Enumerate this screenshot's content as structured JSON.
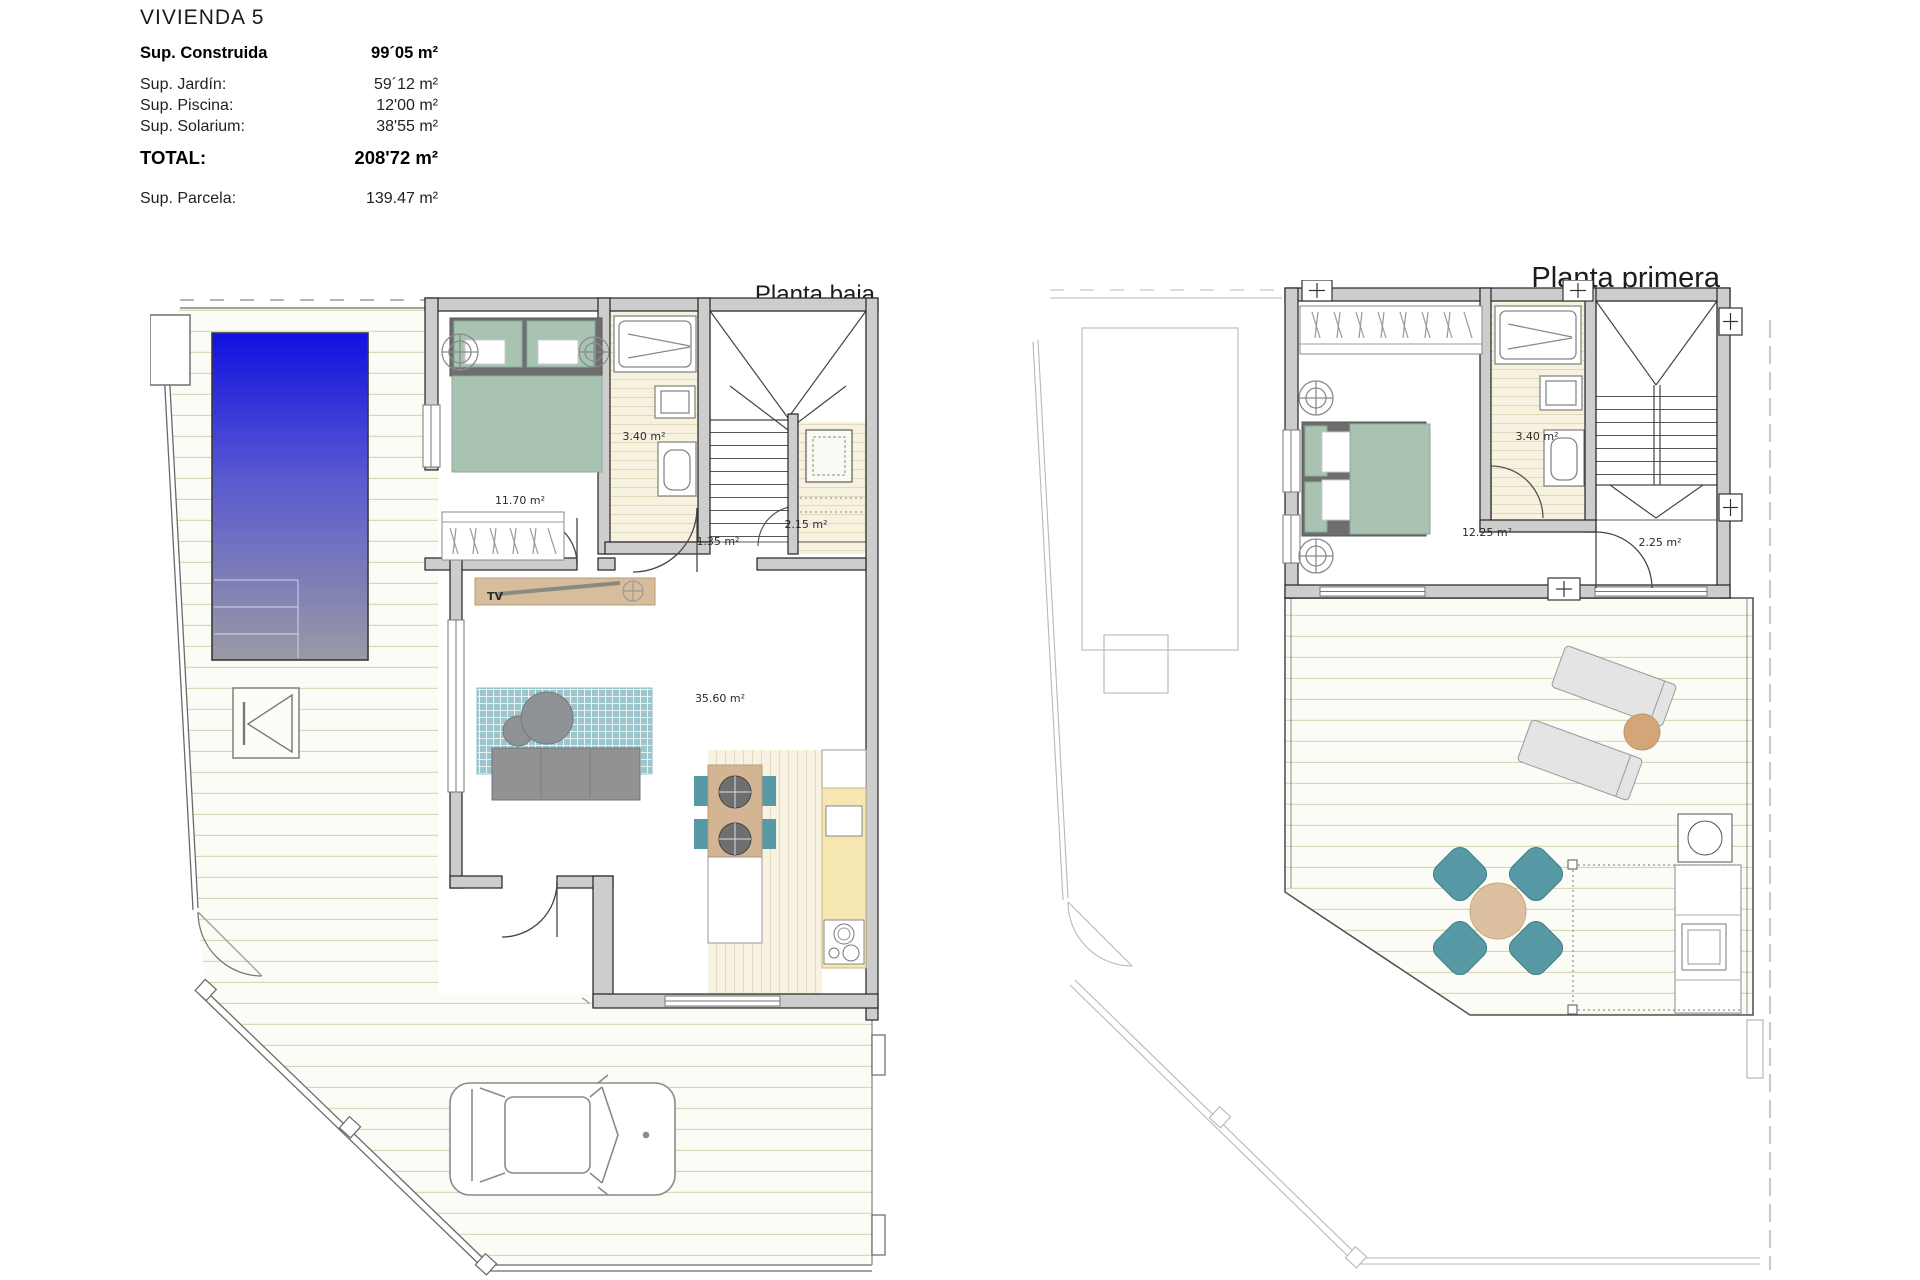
{
  "header": {
    "title": "VIVIENDA 5",
    "rows": [
      {
        "label": "Sup. Construida",
        "value": "99´05 m²"
      },
      {
        "label": "Sup. Jardín:",
        "value": "59´12 m²"
      },
      {
        "label": "Sup. Piscina:",
        "value": "12'00 m²"
      },
      {
        "label": "Sup. Solarium:",
        "value": "38'55 m²"
      },
      {
        "label": "TOTAL:",
        "value": "208'72 m²"
      },
      {
        "label": "Sup. Parcela:",
        "value": "139.47 m²"
      }
    ]
  },
  "plans": {
    "ground": {
      "title": "Planta baja",
      "rooms": {
        "bedroom": "11.70 m²",
        "bathroom": "3.40 m²",
        "hall": "1.35 m²",
        "utility": "2.15 m²",
        "living": "35.60 m²"
      },
      "tv": "TV"
    },
    "first": {
      "title": "Planta primera",
      "rooms": {
        "bathroom": "3.40 m²",
        "bedroom": "12.25 m²",
        "landing": "2.25 m²"
      }
    }
  },
  "colors": {
    "pool_top": "#1010e0",
    "pool_bottom": "#9a9aa4",
    "wall_fill": "#cdcdcd",
    "bed_green": "#a9c3b3",
    "rug_teal": "#8fbfc7",
    "sofa_gray": "#8f9193",
    "wood_tan": "#d3b493",
    "chair_teal": "#579aa5",
    "counter_yellow": "#f6e6b2",
    "lounger_gray": "#e4e4e4",
    "deck_line": "#d8d8ba"
  }
}
